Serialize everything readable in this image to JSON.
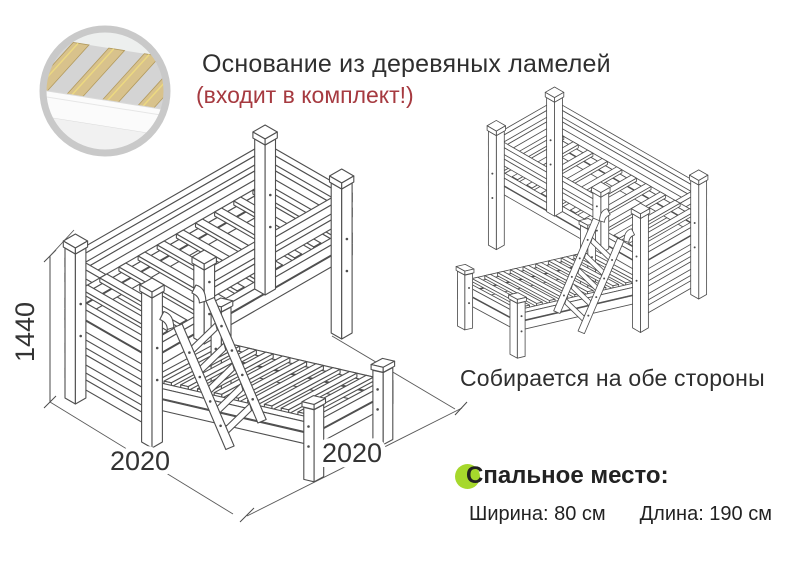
{
  "header": {
    "title": "Основание из деревяных ламелей",
    "subtitle": "(входит в комплект!)"
  },
  "dimensions": {
    "height": "1440",
    "length_left": "2020",
    "length_right": "2020"
  },
  "captions": {
    "both_sides": "Собирается на обе стороны"
  },
  "sleeping_place": {
    "title": "Спальное место:",
    "width": "Ширина: 80 см",
    "length": "Длина: 190 см"
  },
  "colors": {
    "accent_red": "#a63a40",
    "accent_green": "#a6d82c",
    "ink": "#2e2e2e",
    "drawing_line": "#4f4f4f"
  },
  "icons": {
    "inset": "wooden-slats-photo-icon",
    "bullet": "green-dot-icon"
  }
}
